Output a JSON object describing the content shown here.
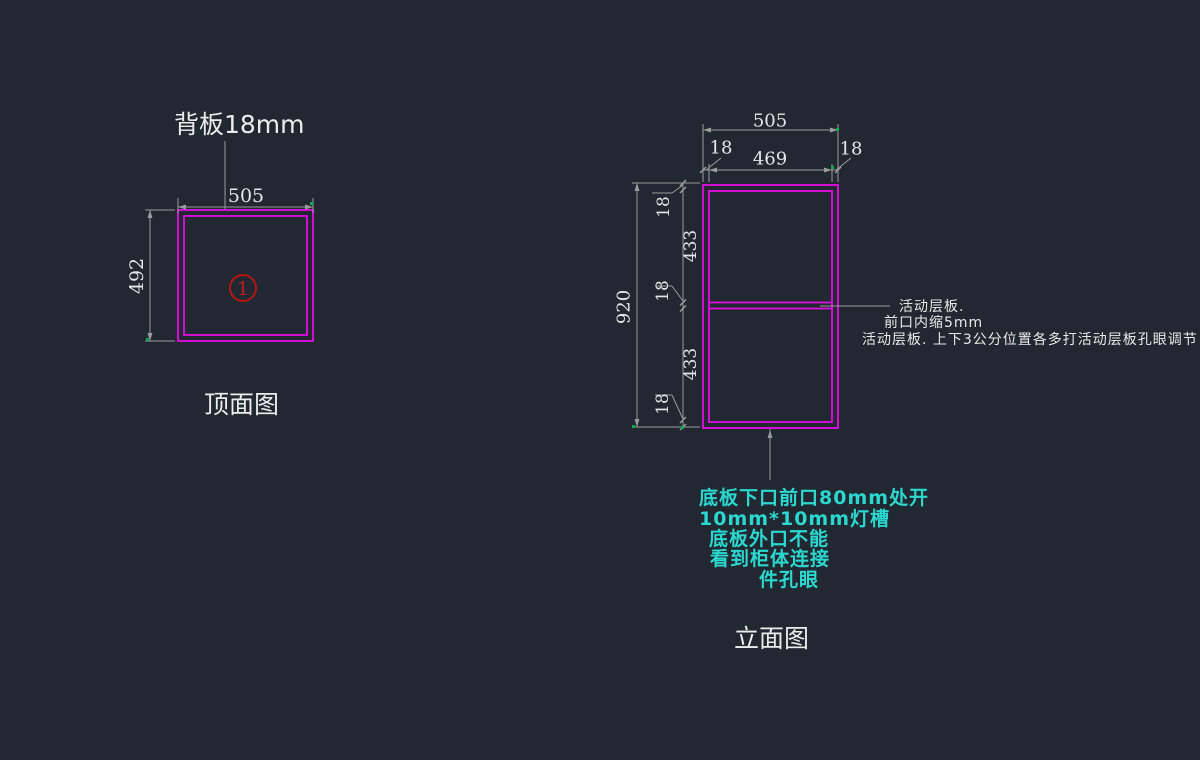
{
  "colors": {
    "background": "#222831",
    "panel_line": "#e50ce5",
    "dimension_line": "#9b9b9b",
    "dimension_text": "#e3e6e8",
    "label_text": "#ececec",
    "note_cyan": "#2bd8cf",
    "balloon_red": "#b31515",
    "snap_green": "#00b050"
  },
  "top_view": {
    "title": "顶面图",
    "callout": "背板18mm",
    "width_dim": "505",
    "height_dim": "492",
    "balloon": "1"
  },
  "elevation": {
    "title": "立面图",
    "overall_width_dim": "505",
    "left_panel_dim": "18",
    "inner_width_dim": "469",
    "right_panel_dim": "18",
    "overall_height_dim": "920",
    "segment_dims": [
      "18",
      "433",
      "18",
      "433",
      "18"
    ],
    "shelf_note_lines": [
      "活动层板.",
      "前口内缩5mm",
      "活动层板. 上下3公分位置各多打活动层板孔眼调节"
    ],
    "bottom_note_lines": [
      "底板下口前口80mm处开",
      "10mm*10mm灯槽",
      "底板外口不能",
      "看到柜体连接",
      "件孔眼"
    ]
  }
}
